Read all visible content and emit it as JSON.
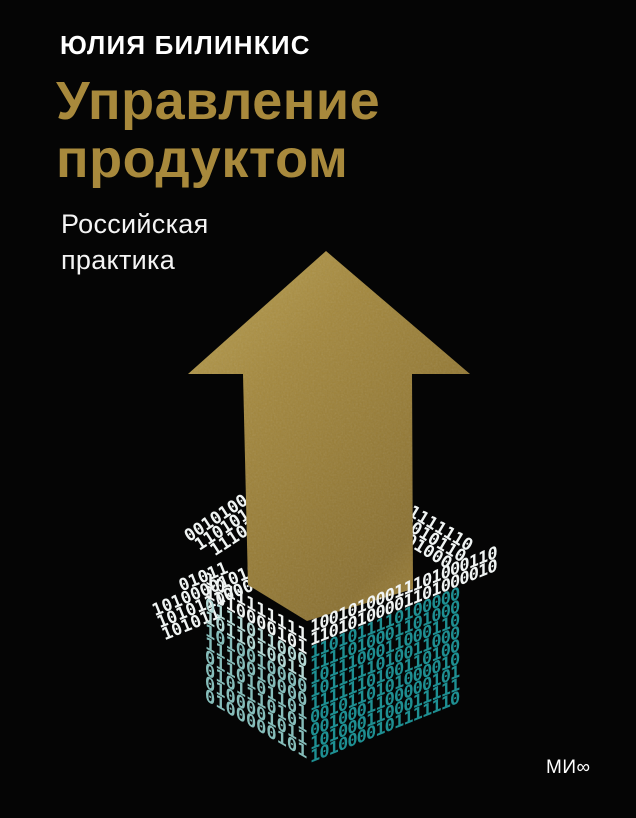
{
  "cover": {
    "author": "ЮЛИЯ БИЛИНКИС",
    "title_line1": "Управление",
    "title_line2": "продуктом",
    "subtitle_line1": "Российская",
    "subtitle_line2": "практика",
    "publisher_logo": "МИ∞"
  },
  "colors": {
    "background": "#050505",
    "title_gold": "#a8893c",
    "arrow_gold_light": "#bba253",
    "arrow_gold_mid": "#9d8139",
    "arrow_gold_dark": "#8a7030",
    "binary_white": "#f0f4f3",
    "binary_teal_left_face": "#86bdba",
    "binary_teal_right_face": "#1e8f92",
    "text_white": "#ffffff"
  },
  "illustration": {
    "arrow": {
      "points": "326,251 470,374 412,374 413,589 307,621 248,585 243,374 188,374"
    },
    "box": {
      "back_flap_left_rows": [
        "0010100",
        "1101010",
        "11101"
      ],
      "back_flap_right_rows": [
        "11111110",
        "0010110",
        "01000"
      ],
      "left_out_flap_rows": [
        "01011",
        "10100001010",
        "1010111000100",
        "101011"
      ],
      "left_face_rows": [
        "1011111111",
        "1010000101",
        "0111011000",
        "1011010011",
        "1010010000",
        "1110010000",
        "0110101101",
        "0101110101",
        "0100001011",
        "0100000101"
      ],
      "right_face_rows": [
        "10010100011101000110",
        "11010100001101000010",
        "1101011110100000",
        "1111010001101000",
        "1011100011000110",
        "1011111010011000",
        "1111110100110100",
        "0010110101000010",
        "0010001100000101",
        "1010001100011111",
        "1010000101111110"
      ]
    }
  }
}
